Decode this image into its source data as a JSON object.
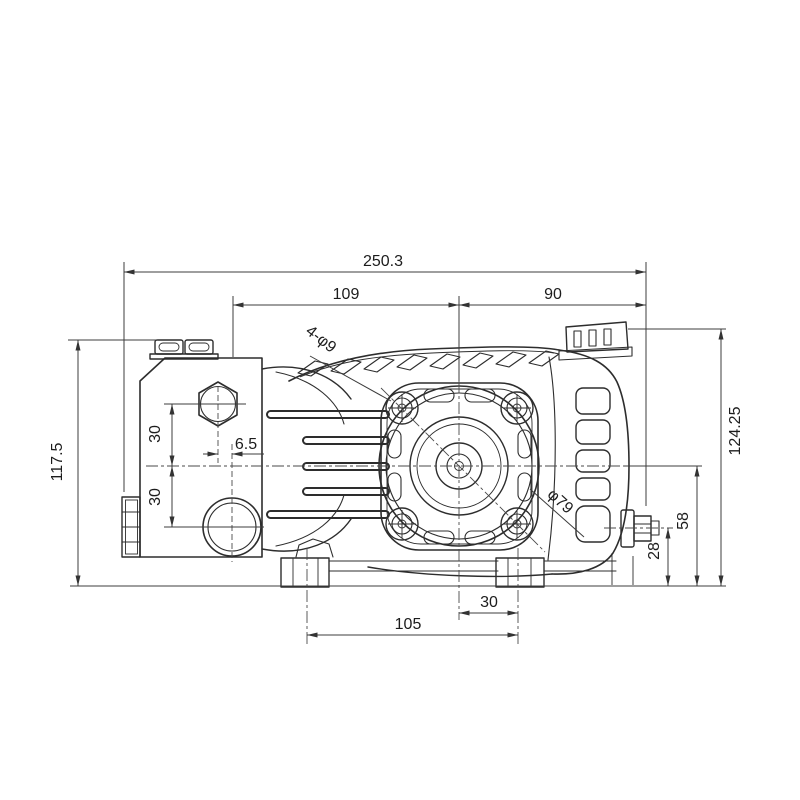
{
  "drawing": {
    "type": "technical-dimension-drawing",
    "colors": {
      "background": "#ffffff",
      "object_line": "#2d2d2d",
      "dimension_line": "#3c3c3c",
      "text": "#1c1c1c"
    },
    "dims": {
      "overall_length": "250.3",
      "upper_left_span": "109",
      "upper_right_span": "90",
      "overall_height_left": "117.5",
      "port_spacing_upper": "30",
      "port_spacing_lower": "30",
      "port_horizontal_offset": "6.5",
      "overall_height_right": "124.25",
      "center_height": "58",
      "outlet_port_height": "28",
      "foot_spacing": "105",
      "foot_to_center": "30",
      "mounting_holes": "4-φ9",
      "bolt_circle": "φ79"
    }
  }
}
